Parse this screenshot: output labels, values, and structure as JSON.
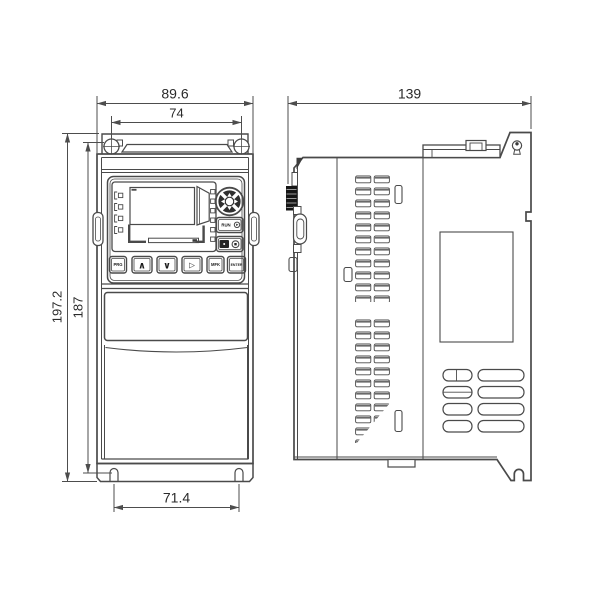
{
  "colors": {
    "background": "#ffffff",
    "line": "#4a4a4a",
    "dim_line": "#4d4d4d",
    "text": "#2a2a2a",
    "knob_fill": "#161616"
  },
  "front_view": {
    "dims": {
      "overall_width": "89.6",
      "mount_hole_spacing_width": "74",
      "overall_height": "197.2",
      "mount_hole_spacing_height": "187",
      "bottom_slot_spacing": "71.4"
    },
    "keypad": {
      "btn_prg": "PRG",
      "btn_up": "∧",
      "btn_down": "∨",
      "btn_shift": "▷",
      "btn_mfk": "MFK",
      "btn_enter": "ENTER",
      "btn_run_label": "RUN"
    },
    "icons": {
      "run_glyph": "run-circle-arrow",
      "stop_glyph": "stop-symbol",
      "nav_dial": "four-way-navigation-dial",
      "mount_holes": "keyhole-mounting-slots"
    }
  },
  "side_view": {
    "dims": {
      "overall_depth": "139"
    },
    "icons": {
      "screw": "keyhole-screw-slot",
      "knob": "ribbed-potentiometer-knob",
      "vents": "louver-vent-slots"
    }
  }
}
